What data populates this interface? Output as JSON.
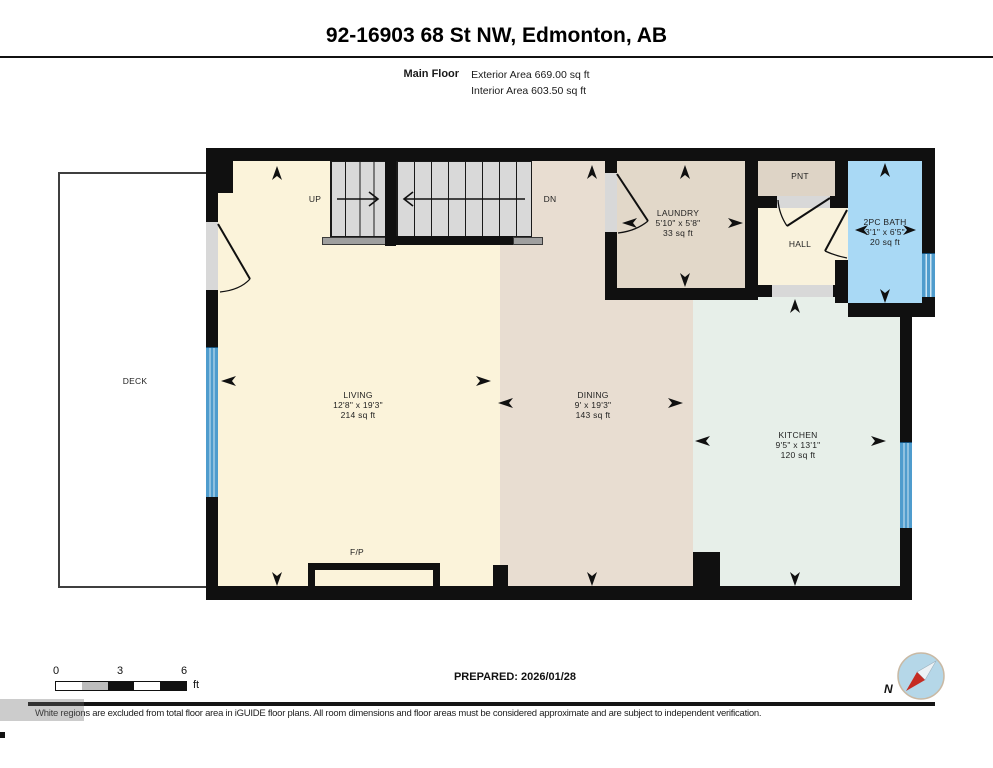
{
  "header": {
    "title": "92-16903 68 St NW, Edmonton, AB",
    "floor_label": "Main Floor",
    "exterior_area": "Exterior Area 669.00 sq ft",
    "interior_area": "Interior Area 603.50 sq ft"
  },
  "rooms": {
    "living": {
      "name": "LIVING",
      "dimensions": "12'8\" x 19'3\"",
      "area": "214 sq ft"
    },
    "dining": {
      "name": "DINING",
      "dimensions": "9' x 19'3\"",
      "area": "143 sq ft"
    },
    "kitchen": {
      "name": "KITCHEN",
      "dimensions": "9'5\" x 13'1\"",
      "area": "120 sq ft"
    },
    "laundry": {
      "name": "LAUNDRY",
      "dimensions": "5'10\" x 5'8\"",
      "area": "33 sq ft"
    },
    "bath": {
      "name": "2PC BATH",
      "dimensions": "3'1\" x 6'5\"",
      "area": "20 sq ft"
    },
    "hall": {
      "name": "HALL"
    },
    "pantry": {
      "name": "PNT"
    },
    "deck": {
      "name": "DECK"
    },
    "fireplace": {
      "name": "F/P"
    }
  },
  "stairs": {
    "up_label": "UP",
    "down_label": "DN"
  },
  "scale": {
    "tick0": "0",
    "tick3": "3",
    "tick6": "6",
    "unit": "ft"
  },
  "footer": {
    "prepared": "PREPARED: 2026/01/28",
    "compass_label": "N",
    "disclaimer": "White regions are excluded from total floor area in iGUIDE floor plans. All room dimensions and floor areas must be considered approximate and are subject to independent verification."
  },
  "colors": {
    "wall": "#101010",
    "living": "#fbf3da",
    "dining": "#e8ddd1",
    "laundry": "#e2d8c9",
    "pantry": "#ded4c6",
    "hall": "#f9f2dc",
    "kitchen": "#e7efe9",
    "bath": "#a9d9f5",
    "stairs": "#d9d9d9",
    "window_blue": "#4f9ccd",
    "opening_gray": "#d8d8d8",
    "compass_red": "#c52b22"
  }
}
